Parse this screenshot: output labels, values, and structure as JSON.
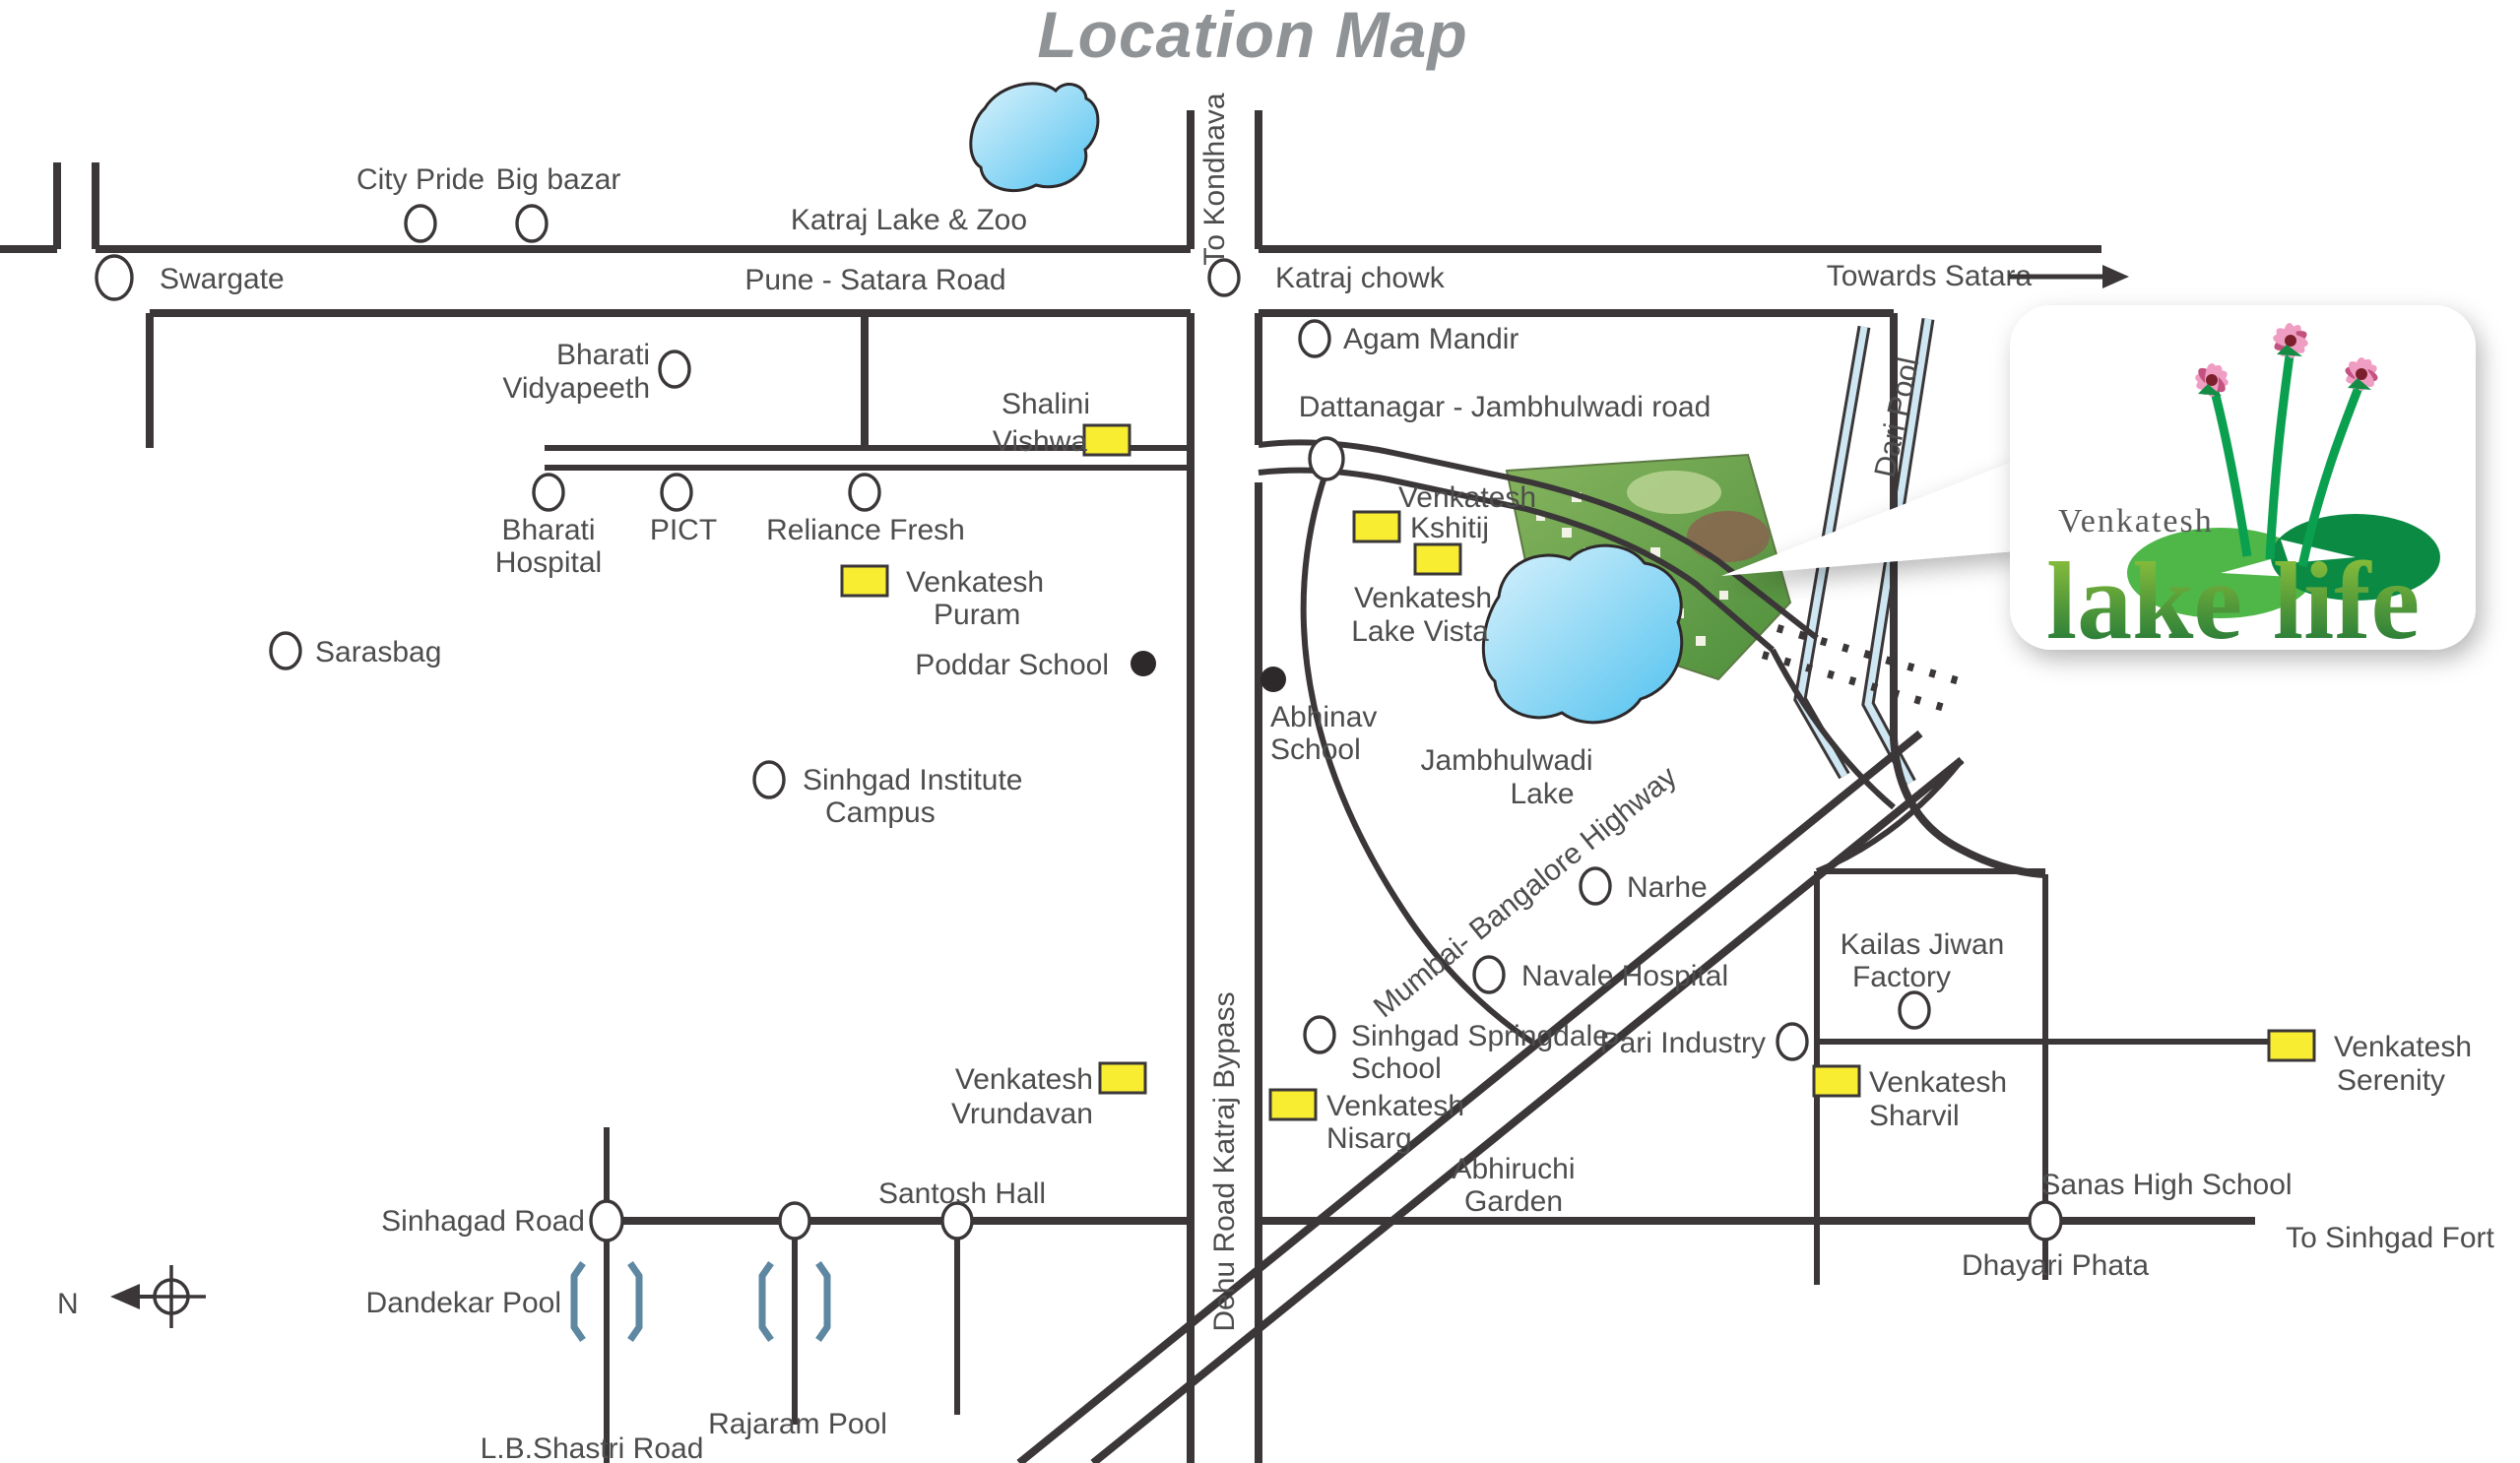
{
  "title": "Location Map",
  "compass": {
    "north_label": "N"
  },
  "logo": {
    "brand": "Venkatesh",
    "word1": "lake",
    "word2": "life"
  },
  "roads": {
    "pune_satara": "Pune - Satara Road",
    "to_kondhava": "To Kondhava",
    "towards_satara": "Towards Satara",
    "dattanagar": "Dattanagar - Jambhulwadi road",
    "dari_pool": "Dari Pool",
    "mumbai_bangalore": "Mumbai- Bangalore Highway",
    "dehu_bypass": "Dehu Road Katraj Bypass",
    "sinhagad_road": "Sinhagad Road",
    "lb_shastri": "L.B.Shastri Road",
    "to_sinhgad_fort": "To Sinhgad Fort"
  },
  "landmarks": {
    "swargate": "Swargate",
    "city_pride": "City Pride",
    "big_bazar": "Big bazar",
    "katraj_lake_zoo": "Katraj Lake & Zoo",
    "katraj_chowk": "Katraj chowk",
    "agam_mandir": "Agam Mandir",
    "bharati_vidyapeeth": {
      "line1": "Bharati",
      "line2": "Vidyapeeth"
    },
    "shalini_vishwa": {
      "line1": "Shalini",
      "line2": "Vishwa"
    },
    "bharati_hospital": {
      "line1": "Bharati",
      "line2": "Hospital"
    },
    "pict": "PICT",
    "reliance_fresh": "Reliance Fresh",
    "sarasbag": "Sarasbag",
    "poddar_school": "Poddar School",
    "abhinav_school": {
      "line1": "Abhinav",
      "line2": "School"
    },
    "sinhgad_institute": {
      "line1": "Sinhgad Institute",
      "line2": "Campus"
    },
    "jambhulwadi_lake": {
      "line1": "Jambhulwadi",
      "line2": "Lake"
    },
    "narhe": "Narhe",
    "navale_hospital": "Navale Hospital",
    "kailas_jiwan": {
      "line1": "Kailas Jiwan",
      "line2": "Factory"
    },
    "pari_industry": "Pari Industry",
    "sinhgad_springdale": {
      "line1": "Sinhgad Springdale",
      "line2": "School"
    },
    "abhiruchi_garden": {
      "line1": "Abhiruchi",
      "line2": "Garden"
    },
    "santosh_hall": "Santosh Hall",
    "dandekar_pool": "Dandekar Pool",
    "rajaram_pool": "Rajaram Pool",
    "sanas_high_school": "Sanas High School",
    "dhayari_phata": "Dhayari Phata"
  },
  "projects": {
    "puram": {
      "line1": "Venkatesh",
      "line2": "Puram"
    },
    "kshitij": {
      "line1": "Venkatesh",
      "line2": "Kshitij"
    },
    "lake_vista": {
      "line1": "Venkatesh",
      "line2": "Lake Vista"
    },
    "vrundavan": {
      "line1": "Venkatesh",
      "line2": "Vrundavan"
    },
    "nisarg": {
      "line1": "Venkatesh",
      "line2": "Nisarg"
    },
    "sharvil": {
      "line1": "Venkatesh",
      "line2": "Sharvil"
    },
    "serenity": {
      "line1": "Venkatesh",
      "line2": "Serenity"
    }
  },
  "colors": {
    "road": "#3b3738",
    "label_text": "#4d4d4d",
    "title_gray": "#8f9396",
    "marker_yellow": "#f9ed32",
    "lake_light": "#cdeefb",
    "lake_dark": "#52c2ef",
    "logo_green_light": "#9bca3c",
    "logo_green_dark": "#146f38",
    "pad_light": "#4eb748",
    "pad_dark": "#0b8a43",
    "flower_pink": "#ef9dc3"
  }
}
